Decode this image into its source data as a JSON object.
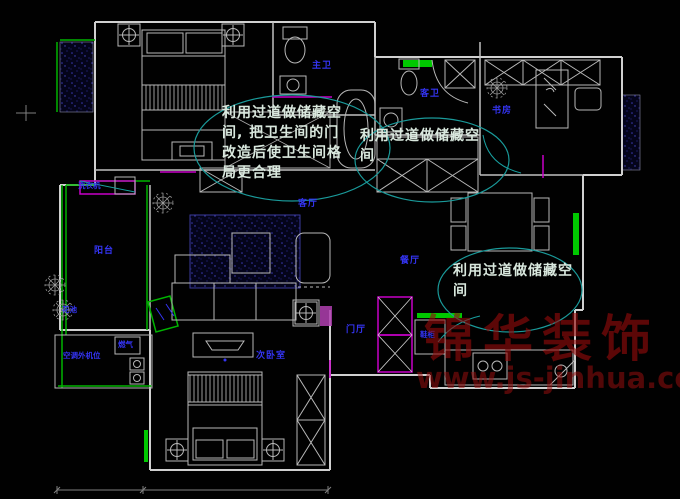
{
  "title": "apartment-floor-plan-cad-drawing",
  "annotations": {
    "note1": {
      "lines": [
        "利用过道做储藏空",
        "间, 把卫生间的门",
        "改造后使卫生间格",
        "局更合理"
      ]
    },
    "note2": {
      "lines": [
        "利用过道做储藏空",
        "间"
      ]
    },
    "note3": {
      "lines": [
        "利用过道做储藏空",
        "间"
      ]
    }
  },
  "room_labels": {
    "master_bath": "主卫",
    "guest_bath": "客卫",
    "study": "书房",
    "living_room": "客厅",
    "dining_room": "餐厅",
    "balcony": "阳台",
    "entry_hall": "门厅",
    "second_bedroom": "次卧室",
    "shoe_cabinet": "鞋柜",
    "flower_bed": "花池",
    "ac_platform": "空调外机位",
    "washing_machine": "洗衣机",
    "gas_meter": "燃气"
  },
  "watermark": {
    "brand": "锦华装饰",
    "url_text": "www.js-jinhua.com"
  },
  "colors": {
    "background": "#010101",
    "wall_line": "#d0d0d0",
    "green_accent": "#00b400",
    "magenta_accent": "#c800c8",
    "cyan_annotation": "#1a9a9a",
    "label_blue": "#3434f2",
    "watermark_red": "#940c0c",
    "window_hatch": "#3a3ab0"
  }
}
